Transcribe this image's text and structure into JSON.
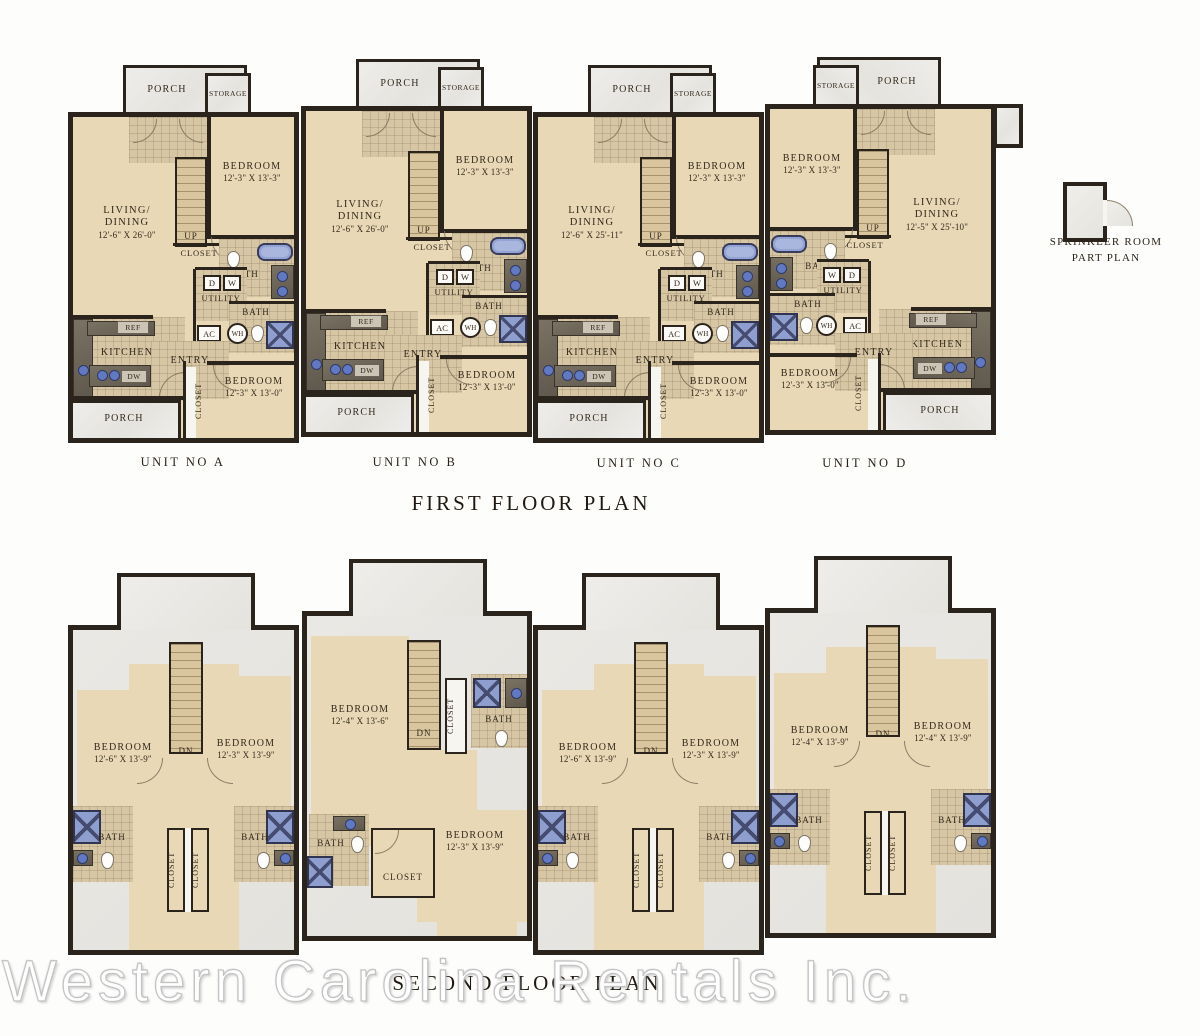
{
  "titles": {
    "first_floor": "FIRST FLOOR PLAN",
    "second_floor": "SECOND FLOOR PLAN",
    "sprinkler_line1": "SPRINKLER ROOM",
    "sprinkler_line2": "PART PLAN",
    "watermark": "Western Carolina Rentals Inc."
  },
  "unit_labels": {
    "a": "UNIT NO A",
    "b": "UNIT NO B",
    "c": "UNIT NO C",
    "d": "UNIT NO D"
  },
  "room_labels": {
    "porch": "PORCH",
    "storage": "STORAGE",
    "bedroom": "BEDROOM",
    "living_line1": "LIVING/",
    "living_line2": "DINING",
    "up": "UP",
    "dn": "DN",
    "closet": "CLOSET",
    "bath": "BATH",
    "utility": "UTILITY",
    "dryer": "D",
    "washer": "W",
    "ac": "AC",
    "wh": "WH",
    "ref": "REF",
    "dw": "DW",
    "kitchen": "KITCHEN",
    "entry": "ENTRY"
  },
  "first_floor": {
    "a": {
      "bedroom1_dim": "12'-3\" X 13'-3\"",
      "living_dim": "12'-6\" X 26'-0\"",
      "bedroom2_dim": "12'-3\" X 13'-0\""
    },
    "b": {
      "bedroom1_dim": "12'-3\" X 13'-3\"",
      "living_dim": "12'-6\" X 26'-0\"",
      "bedroom2_dim": "12'-3\" X 13'-0\""
    },
    "c": {
      "bedroom1_dim": "12'-3\" X 13'-3\"",
      "living_dim": "12'-6\" X 25'-11\"",
      "bedroom2_dim": "12'-3\" X 13'-0\""
    },
    "d": {
      "bedroom1_dim": "12'-3\" X 13'-3\"",
      "living_dim": "12'-5\" X 25'-10\"",
      "bedroom2_dim": "12'-3\" X 13'-0\""
    }
  },
  "second_floor": {
    "a": {
      "bedroom_left_dim": "12'-6\" X 13'-9\"",
      "bedroom_right_dim": "12'-3\" X 13'-9\""
    },
    "b": {
      "bedroom_left_dim": "12'-4\" X 13'-6\"",
      "bedroom_right_dim": "12'-3\" X 13'-9\""
    },
    "c": {
      "bedroom_left_dim": "12'-6\" X 13'-9\"",
      "bedroom_right_dim": "12'-3\" X 13'-9\""
    },
    "d": {
      "bedroom_left_dim": "12'-4\" X 13'-9\"",
      "bedroom_right_dim": "12'-4\" X 13'-9\""
    }
  },
  "colors": {
    "wall": "#2b241d",
    "room_fill": "#e8d8b5",
    "tile_fill": "#d6c6a4",
    "porch_fill": "#eae8e4",
    "fixture_blue": "#8d9ecf",
    "counter": "#6f685c",
    "text": "#33291d"
  }
}
